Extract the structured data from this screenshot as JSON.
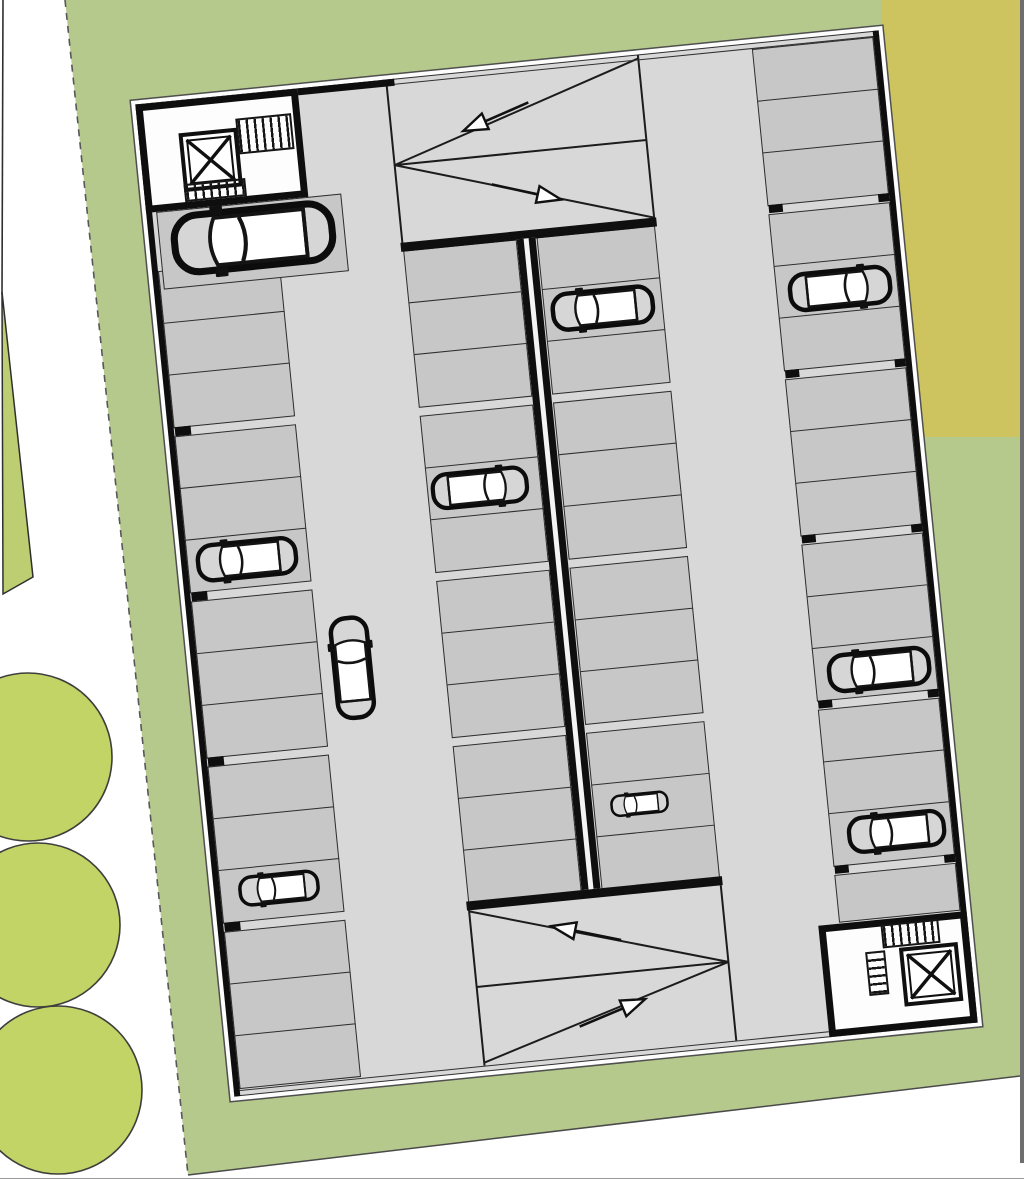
{
  "scene": {
    "type": "architectural-floor-plan",
    "subject": "underground parking garage level on landscaped site",
    "stats": {
      "parking_stalls": 56,
      "parked_cars": 9,
      "moving_cars": 1,
      "stairwells": 2,
      "elevators": 2,
      "ramps": 2,
      "direction_arrows": 4,
      "trees": 3
    }
  },
  "colors": {
    "page_bg": "#ffffff",
    "site_green": "#b5c98d",
    "tree_green": "#c2d465",
    "wedge_green": "#bdce72",
    "adjacent_lot_olive": "#cec45f",
    "road_strip_gray": "#6e6e6e",
    "aisle_gray": "#d8d8d8",
    "stall_gray": "#c7c7c7",
    "wall_black": "#0e0e0e",
    "stairwell_white": "#fdfdfd"
  },
  "site": {
    "green_points": "65,0 1020,0 1020,1076 188,1175",
    "olive_rect": {
      "x": 881,
      "y": 0,
      "w": 139,
      "h": 437
    },
    "road_rect": {
      "x": 1020,
      "y": 0,
      "w": 4,
      "h": 1163
    },
    "wedge_points": "2,292 33,577 3,594",
    "dash_line": {
      "x1": 65,
      "y1": 0,
      "x2": 188,
      "y2": 1175
    },
    "bottom_line": {
      "x1": 188,
      "y1": 1175,
      "x2": 1020,
      "y2": 1076
    },
    "left_line": {
      "x1": 3,
      "y1": 0,
      "x2": 2,
      "y2": 295
    },
    "hairline_y": 1178.5,
    "trees": [
      {
        "cx": 28,
        "cy": 757,
        "r": 84
      },
      {
        "cx": 38,
        "cy": 925,
        "r": 82
      },
      {
        "cx": 58,
        "cy": 1090,
        "r": 84
      }
    ]
  },
  "garage": {
    "x": 183,
    "y": 65,
    "w": 747,
    "h": 997,
    "angle_deg": -5.7,
    "columns": [
      {
        "id": "west-column",
        "x": 6,
        "w": 122,
        "stall_h": 52,
        "groups": [
          {
            "y": 168,
            "n": 3
          },
          {
            "y": 334,
            "n": 3
          },
          {
            "y": 500,
            "n": 3
          },
          {
            "y": 666,
            "n": 3
          },
          {
            "y": 832,
            "n": 3
          }
        ]
      },
      {
        "id": "west-wide-stall",
        "x": 10,
        "w": 186,
        "stall_h": 76,
        "groups": [
          {
            "y": 109,
            "n": 1
          }
        ]
      },
      {
        "id": "center-west-column",
        "x": 252,
        "w": 114,
        "stall_h": 52,
        "groups": [
          {
            "y": 172,
            "n": 3
          },
          {
            "y": 338,
            "n": 3
          },
          {
            "y": 504,
            "n": 3
          },
          {
            "y": 670,
            "n": 3
          }
        ]
      },
      {
        "id": "center-east-column",
        "x": 386,
        "w": 119,
        "stall_h": 52,
        "groups": [
          {
            "y": 172,
            "n": 3
          },
          {
            "y": 338,
            "n": 3
          },
          {
            "y": 504,
            "n": 3
          },
          {
            "y": 670,
            "n": 3
          }
        ]
      },
      {
        "id": "east-column",
        "x": 619,
        "w": 122,
        "stall_h": 52,
        "groups": [
          {
            "y": 6,
            "n": 3
          },
          {
            "y": 172,
            "n": 3
          },
          {
            "y": 338,
            "n": 3
          },
          {
            "y": 504,
            "n": 3
          },
          {
            "y": 670,
            "n": 3
          },
          {
            "y": 836,
            "n": 1,
            "h": 46
          }
        ]
      }
    ],
    "pillars": [
      {
        "x": 7,
        "y": 325,
        "w": 16,
        "h": 9
      },
      {
        "x": 7,
        "y": 491,
        "w": 16,
        "h": 9
      },
      {
        "x": 7,
        "y": 657,
        "w": 16,
        "h": 9
      },
      {
        "x": 7,
        "y": 823,
        "w": 16,
        "h": 9
      },
      {
        "x": 620,
        "y": 163,
        "w": 14,
        "h": 8
      },
      {
        "x": 620,
        "y": 329,
        "w": 14,
        "h": 8
      },
      {
        "x": 620,
        "y": 495,
        "w": 14,
        "h": 8
      },
      {
        "x": 620,
        "y": 661,
        "w": 14,
        "h": 8
      },
      {
        "x": 620,
        "y": 827,
        "w": 14,
        "h": 8
      },
      {
        "x": 730,
        "y": 163,
        "w": 11,
        "h": 8
      },
      {
        "x": 730,
        "y": 329,
        "w": 11,
        "h": 8
      },
      {
        "x": 730,
        "y": 495,
        "w": 11,
        "h": 8
      },
      {
        "x": 730,
        "y": 661,
        "w": 11,
        "h": 8
      },
      {
        "x": 730,
        "y": 827,
        "w": 11,
        "h": 8
      }
    ],
    "cars": [
      {
        "x": 104,
        "y": 144,
        "rot": 0,
        "flip": false,
        "scale": 1.58,
        "location": "wide stall beside north stairwell"
      },
      {
        "x": 160,
        "y": 582,
        "rot": 90,
        "flip": false,
        "scale": 1.0,
        "location": "driving in west aisle"
      },
      {
        "x": 305,
        "y": 416,
        "rot": 0,
        "flip": true,
        "scale": 0.94,
        "location": "center-west column"
      },
      {
        "x": 66,
        "y": 464,
        "rot": 0,
        "flip": false,
        "scale": 0.98,
        "location": "west column"
      },
      {
        "x": 65,
        "y": 794,
        "rot": 0,
        "flip": false,
        "scale": 0.78,
        "location": "west column"
      },
      {
        "x": 445,
        "y": 249,
        "rot": 0,
        "flip": false,
        "scale": 1.0,
        "location": "center-east column"
      },
      {
        "x": 432,
        "y": 746,
        "rot": 0,
        "flip": false,
        "scale": 0.56,
        "location": "center-east column"
      },
      {
        "x": 683,
        "y": 253,
        "rot": 0,
        "flip": true,
        "scale": 1.0,
        "location": "east column"
      },
      {
        "x": 684,
        "y": 636,
        "rot": 0,
        "flip": false,
        "scale": 1.0,
        "location": "east column"
      },
      {
        "x": 685,
        "y": 799,
        "rot": 0,
        "flip": false,
        "scale": 0.95,
        "location": "east column"
      }
    ],
    "arrows": [
      {
        "x": 357,
        "y": 48,
        "angle": 162,
        "ramp": "north",
        "direction": "up"
      },
      {
        "x": 381,
        "y": 126,
        "angle": 18,
        "ramp": "north",
        "direction": "down"
      },
      {
        "x": 366,
        "y": 869,
        "angle": -163,
        "ramp": "south",
        "direction": "up"
      },
      {
        "x": 385,
        "y": 951,
        "angle": -17,
        "ramp": "south",
        "direction": "down"
      }
    ]
  }
}
